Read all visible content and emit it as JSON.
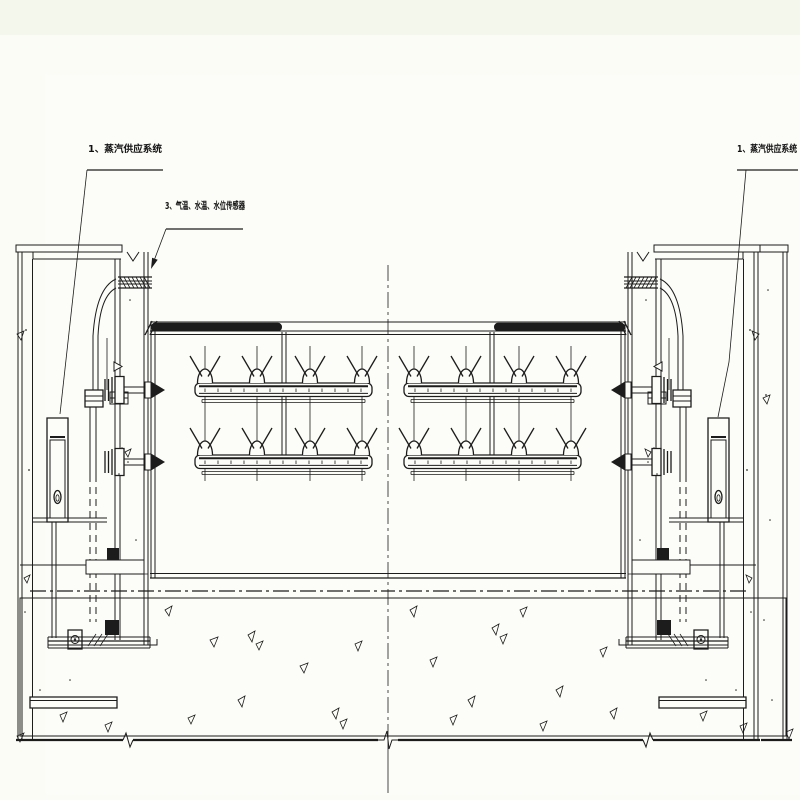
{
  "page": {
    "background_color": "#f7f9f0",
    "paper_color": "#fcfdf8",
    "ink_color": "#1c1c1c",
    "drawing_type": "gate-section-engineering-drawing"
  },
  "callouts": {
    "left_steam_system": "1、蒸汽供应系统",
    "sensor_line": "3、气温、水温、水位传感器",
    "right_steam_system": "1、蒸汽供应系统"
  }
}
